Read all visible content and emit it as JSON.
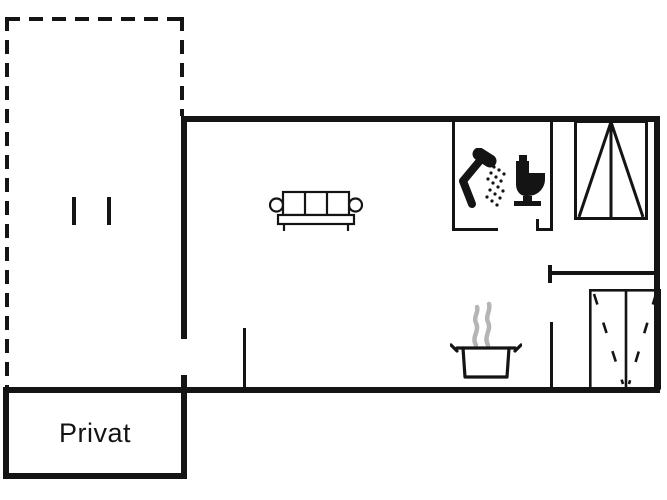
{
  "labels": {
    "privat": "Privat"
  },
  "colors": {
    "wall": "#141414",
    "background": "#ffffff",
    "steam": "#b5b5b5"
  },
  "icons": [
    "sofa-icon",
    "shower-icon",
    "toilet-icon",
    "wardrobe-top-icon",
    "wardrobe-bottom-icon",
    "cooking-pot-icon",
    "terrace-door-marks"
  ]
}
